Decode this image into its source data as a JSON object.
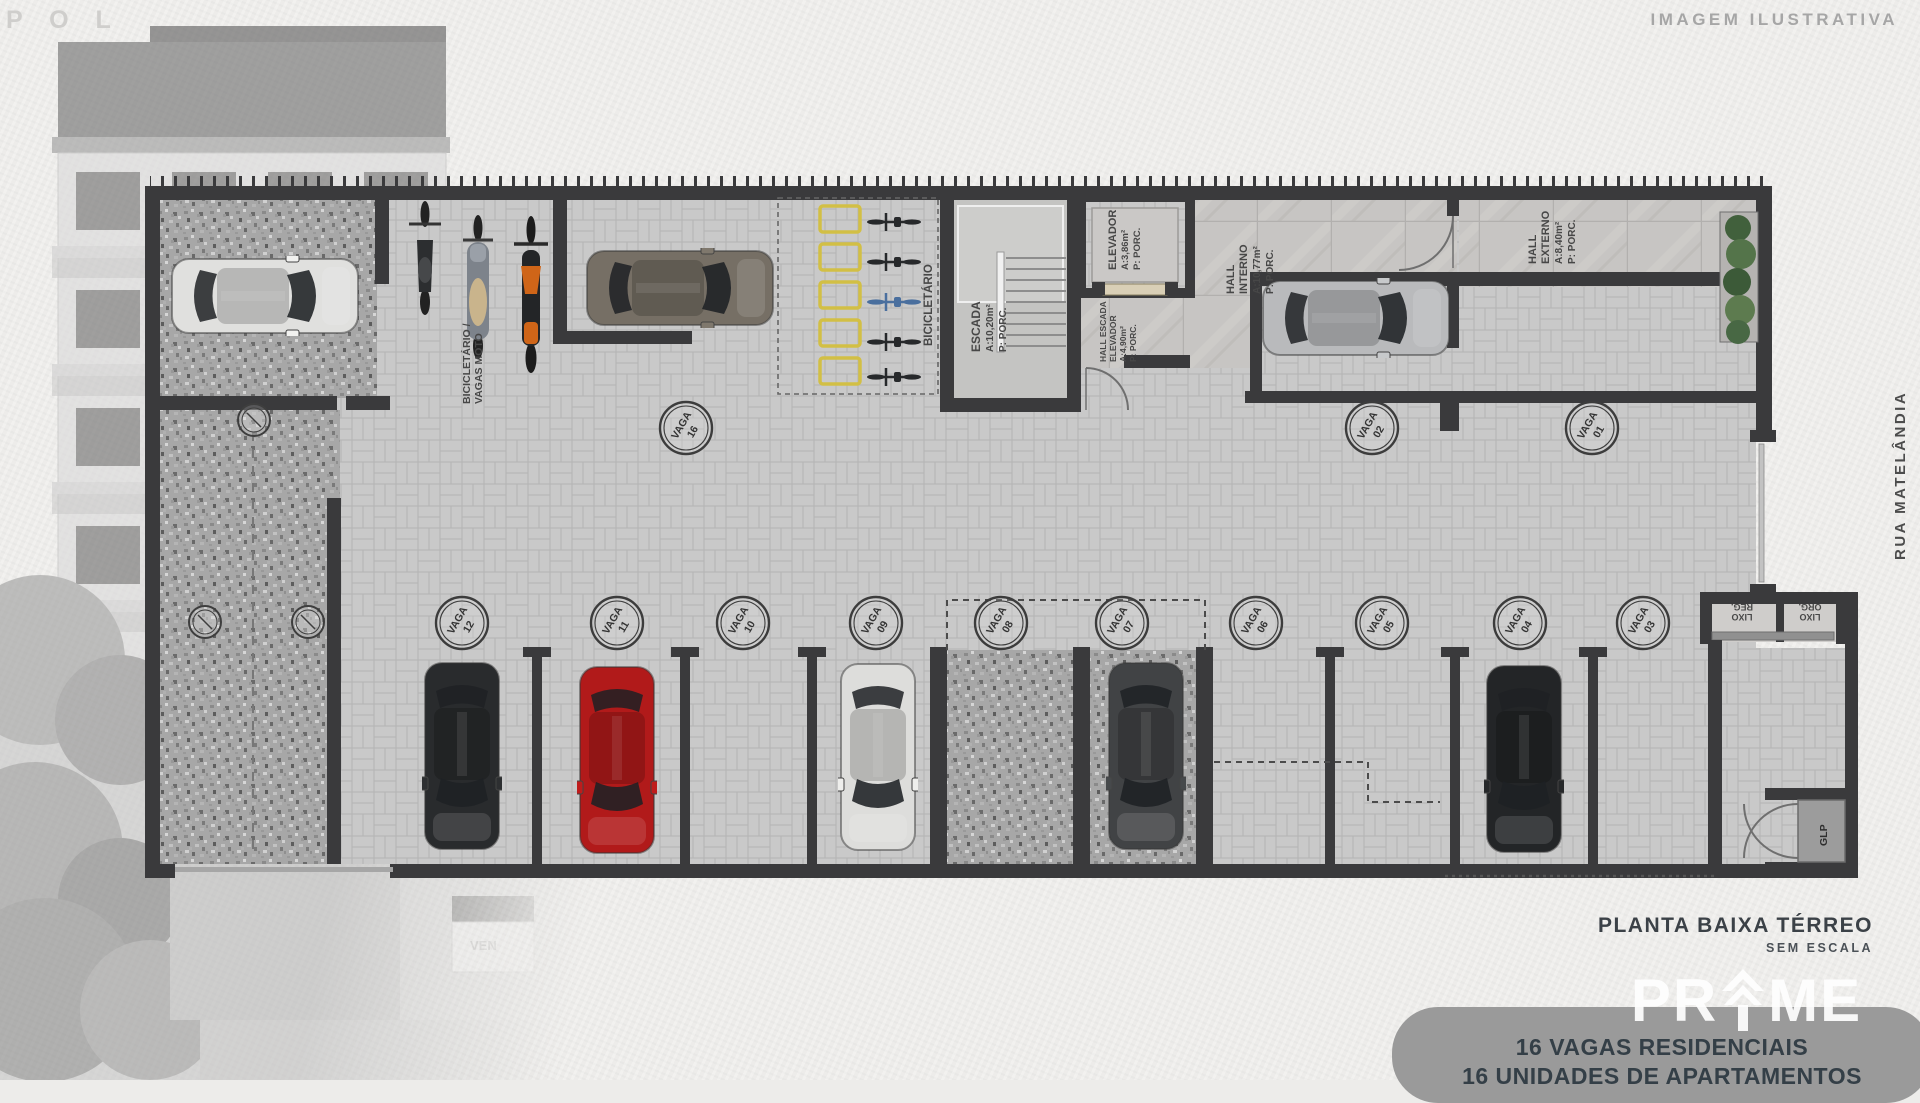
{
  "meta": {
    "corner_watermark": "P O L",
    "top_right_note": "IMAGEM ILUSTRATIVA",
    "street": "RUA MATELÂNDIA"
  },
  "title_block": {
    "title": "PLANTA BAIXA TÉRREO",
    "scale": "SEM ESCALA",
    "brand": {
      "full": "PRIME",
      "left": "PR",
      "right": "ME"
    },
    "stats": [
      "16 VAGAS RESIDENCIAIS",
      "16 UNIDADES DE APARTAMENTOS"
    ]
  },
  "photo": {
    "sign": "VEN"
  },
  "labels": {
    "bicicletario": "BICICLETÁRIO",
    "bicicletario_moto_1": "BICICLETÁRIO /",
    "bicicletario_moto_2": "VAGAS MOTO",
    "escada": {
      "name": "ESCADA",
      "area": "A:10,20m²",
      "floor": "P: PORC."
    },
    "elevador": {
      "name": "ELEVADOR",
      "area": "A:3,86m²",
      "floor": "P: PORC."
    },
    "hall_escada_elevador": {
      "l1": "HALL ESCADA",
      "l2": "ELEVADOR",
      "area": "A:4,90m²",
      "floor": "P: PORC."
    },
    "hall_interno": {
      "l1": "HALL",
      "l2": "INTERNO",
      "area": "A:10,77m²",
      "floor": "P: PORC."
    },
    "hall_externo": {
      "l1": "HALL",
      "l2": "EXTERNO",
      "area": "A:8,40m²",
      "floor": "P: PORC."
    },
    "lixo_reg": {
      "l1": "LIXO",
      "l2": "REG."
    },
    "lixo_org": {
      "l1": "LIXO",
      "l2": "ORG."
    },
    "glp": "GLP"
  },
  "spots": [
    {
      "label": "VAGA",
      "number": "16"
    },
    {
      "label": "VAGA",
      "number": "02"
    },
    {
      "label": "VAGA",
      "number": "01"
    },
    {
      "label": "VAGA",
      "number": "12"
    },
    {
      "label": "VAGA",
      "number": "11"
    },
    {
      "label": "VAGA",
      "number": "10"
    },
    {
      "label": "VAGA",
      "number": "09"
    },
    {
      "label": "VAGA",
      "number": "08"
    },
    {
      "label": "VAGA",
      "number": "07"
    },
    {
      "label": "VAGA",
      "number": "06"
    },
    {
      "label": "VAGA",
      "number": "05"
    },
    {
      "label": "VAGA",
      "number": "04"
    },
    {
      "label": "VAGA",
      "number": "03"
    }
  ]
}
